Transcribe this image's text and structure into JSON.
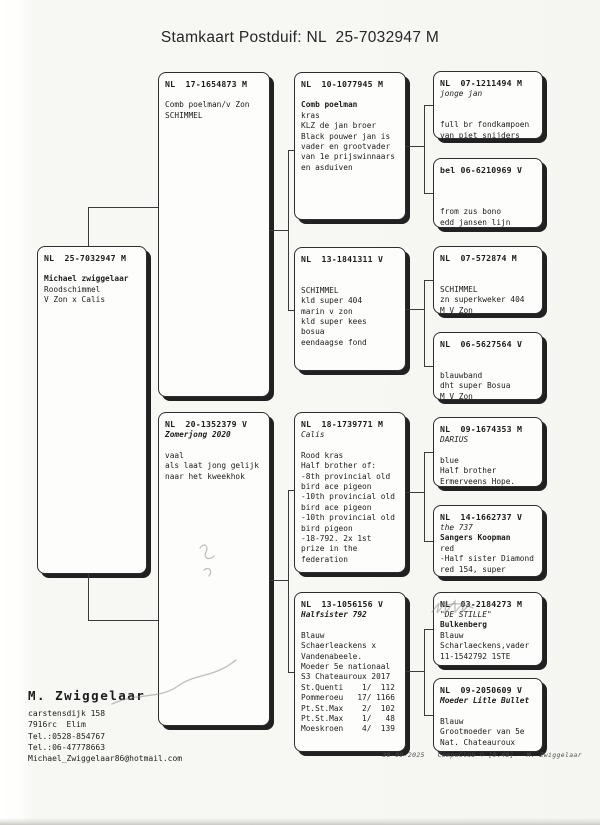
{
  "title": "Stamkaart Postduif: NL  25-7032947 M",
  "boxes": [
    {
      "id": "subject",
      "ring": "NL  25-7032947 M",
      "lines": [
        {
          "t": ""
        },
        {
          "t": "Michael zwiggelaar",
          "b": 1
        },
        {
          "t": "Roodschimmel"
        },
        {
          "t": "V Zon x Calis"
        }
      ]
    },
    {
      "id": "sire",
      "ring": "NL  17-1654873 M",
      "lines": [
        {
          "t": ""
        },
        {
          "t": "Comb poelman/v Zon"
        },
        {
          "t": "SCHIMMEL"
        }
      ]
    },
    {
      "id": "dam",
      "ring": "NL  20-1352379 V",
      "lines": [
        {
          "t": "Zomerjong 2020",
          "b": 1,
          "i": 1
        },
        {
          "t": ""
        },
        {
          "t": "vaal"
        },
        {
          "t": "als laat jong gelijk"
        },
        {
          "t": "naar het kweekhok"
        }
      ]
    },
    {
      "id": "pgf",
      "ring": "NL  10-1077945 M",
      "lines": [
        {
          "t": ""
        },
        {
          "t": "Comb poelman",
          "b": 1
        },
        {
          "t": "kras"
        },
        {
          "t": "KLZ de jan broer"
        },
        {
          "t": "Black pouwer jan is"
        },
        {
          "t": "vader en grootvader"
        },
        {
          "t": "van 1e prijswinnaars"
        },
        {
          "t": "en asduiven"
        }
      ]
    },
    {
      "id": "pgm",
      "ring": "NL  13-1841311 V",
      "lines": [
        {
          "t": ""
        },
        {
          "t": ""
        },
        {
          "t": "SCHIMMEL"
        },
        {
          "t": "kld super 404"
        },
        {
          "t": "marin v zon"
        },
        {
          "t": "kld super kees"
        },
        {
          "t": "bosua"
        },
        {
          "t": "eendaagse fond"
        }
      ]
    },
    {
      "id": "mgf",
      "ring": "NL  18-1739771 M",
      "lines": [
        {
          "t": "Calis",
          "i": 1
        },
        {
          "t": ""
        },
        {
          "t": "Rood kras"
        },
        {
          "t": "Half brother of:"
        },
        {
          "t": "-8th provincial old"
        },
        {
          "t": "bird ace pigeon"
        },
        {
          "t": "-10th provincial old"
        },
        {
          "t": "bird ace pigeon"
        },
        {
          "t": "-10th provincial old"
        },
        {
          "t": "bird pigeon"
        },
        {
          "t": "-18-792. 2x 1st"
        },
        {
          "t": "prize in the"
        },
        {
          "t": "federation"
        }
      ]
    },
    {
      "id": "mgm",
      "ring": "NL  13-1056156 V",
      "lines": [
        {
          "t": "Halfsister 792",
          "b": 1,
          "i": 1
        },
        {
          "t": ""
        },
        {
          "t": "Blauw"
        },
        {
          "t": "Schaerleackens x"
        },
        {
          "t": "Vandenabeele."
        },
        {
          "t": "Moeder 5e nationaal"
        },
        {
          "t": "S3 Chateauroux 2017"
        },
        {
          "t": "St.Quenti    1/  112"
        },
        {
          "t": "Pommeroeu   17/ 1166"
        },
        {
          "t": "Pt.St.Max    2/  102"
        },
        {
          "t": "Pt.St.Max    1/   48"
        },
        {
          "t": "Moeskroen    4/  139"
        }
      ]
    },
    {
      "id": "ggf1",
      "ring": "NL  07-1211494 M",
      "lines": [
        {
          "t": "jonge jan",
          "i": 1
        },
        {
          "t": ""
        },
        {
          "t": ""
        },
        {
          "t": "full br fondkampoen"
        },
        {
          "t": "van piet snijders"
        }
      ]
    },
    {
      "id": "ggm1",
      "ring": "bel 06-6210969 V",
      "lines": [
        {
          "t": ""
        },
        {
          "t": ""
        },
        {
          "t": ""
        },
        {
          "t": "from zus bono"
        },
        {
          "t": "edd jansen lijn"
        }
      ]
    },
    {
      "id": "ggf2",
      "ring": "NL  07-572874 M",
      "lines": [
        {
          "t": ""
        },
        {
          "t": ""
        },
        {
          "t": "SCHIMMEL"
        },
        {
          "t": "zn superkweker 404"
        },
        {
          "t": "M V Zon"
        }
      ]
    },
    {
      "id": "ggm2",
      "ring": "NL  06-5627564 V",
      "lines": [
        {
          "t": ""
        },
        {
          "t": ""
        },
        {
          "t": "blauwband"
        },
        {
          "t": "dht super Bosua"
        },
        {
          "t": "M V Zon"
        }
      ]
    },
    {
      "id": "ggf3",
      "ring": "NL  09-1674353 M",
      "lines": [
        {
          "t": "DARIUS",
          "i": 1
        },
        {
          "t": ""
        },
        {
          "t": "blue"
        },
        {
          "t": "Half brother"
        },
        {
          "t": "Ermerveens Hope."
        }
      ]
    },
    {
      "id": "ggm3",
      "ring": "NL  14-1662737 V",
      "lines": [
        {
          "t": "the 737",
          "i": 1
        },
        {
          "t": "Sangers Koopman",
          "b": 1
        },
        {
          "t": "red"
        },
        {
          "t": "-Half sister Diamond"
        },
        {
          "t": "red 154, super"
        }
      ]
    },
    {
      "id": "ggf4",
      "ring": "NL  03-2184273 M",
      "lines": [
        {
          "t": "\"DE STILLE\"",
          "i": 1
        },
        {
          "t": "Bulkenberg",
          "b": 1
        },
        {
          "t": "Blauw"
        },
        {
          "t": "Scharlaeckens,vader"
        },
        {
          "t": "11-1542792 1STE"
        }
      ]
    },
    {
      "id": "ggm4",
      "ring": "NL  09-2050609 V",
      "lines": [
        {
          "t": "Moeder Litle Bullet",
          "b": 1,
          "i": 1
        },
        {
          "t": ""
        },
        {
          "t": "Blauw"
        },
        {
          "t": "Grootmoeder van 5e"
        },
        {
          "t": "Nat. Chateauroux"
        }
      ]
    }
  ],
  "owner": {
    "name": "M. Zwiggelaar",
    "address1": "carstensdijk 158",
    "address2": "7916rc  Elim",
    "phone1": "Tel.:0528-854767",
    "phone2": "Tel.:06-47778663",
    "email": "Michael_Zwiggelaar86@hotmail.com"
  },
  "footer": "30-09-2025   CompuClub © [9.48]   M. Zwiggelaar",
  "colors": {
    "ink": "#1c1c1c",
    "box_border": "#2e2e2e",
    "shadow": "#212121",
    "paper": "#f7f7f4"
  }
}
